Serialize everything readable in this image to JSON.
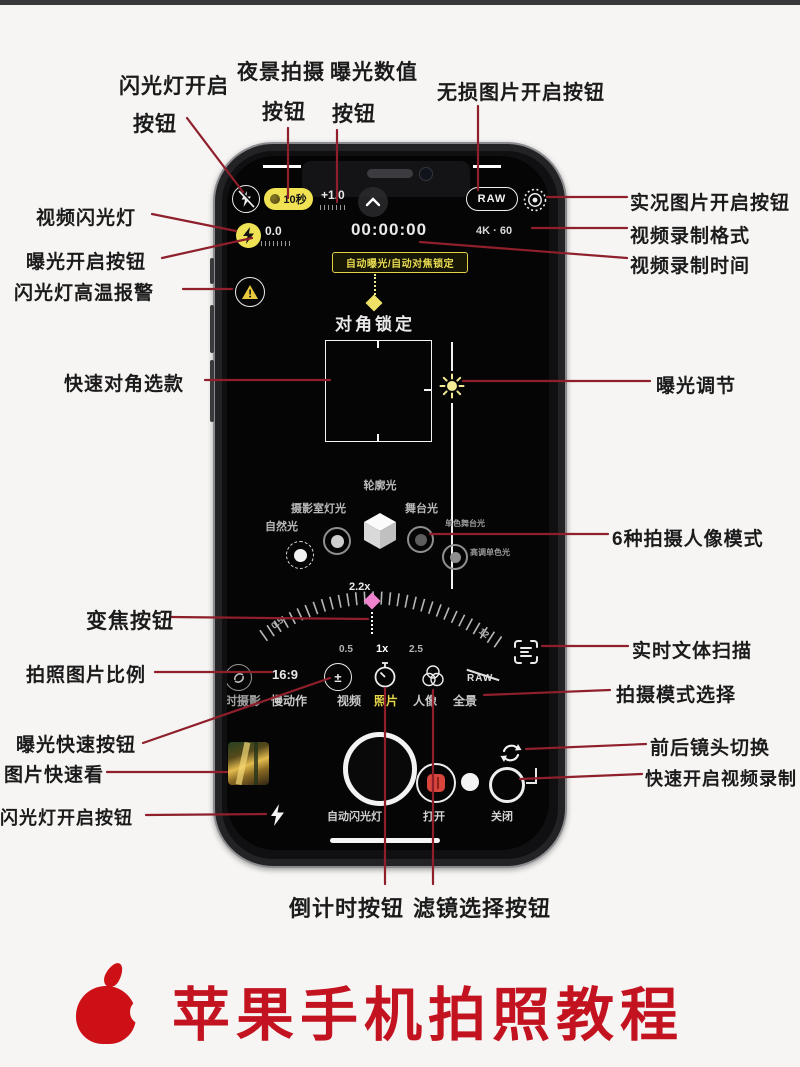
{
  "page": {
    "accent_line_color": "#8e1f2b",
    "title_color": "#c41320"
  },
  "callouts": {
    "flash_on_top": {
      "line1": "闪光灯开启",
      "line2": "按钮"
    },
    "night_mode": {
      "line1": "夜景拍摄",
      "line2": "按钮"
    },
    "exposure_value": {
      "line1": "曝光数值",
      "line2": "按钮"
    },
    "lossless": "无损图片开启按钮",
    "live_photo": "实况图片开启按钮",
    "video_format": "视频录制格式",
    "video_time": "视频录制时间",
    "video_flash": "视频闪光灯",
    "exposure_on": "曝光开启按钮",
    "flash_heat": "闪光灯高温报警",
    "quick_diag": "快速对角选款",
    "exposure_adjust": "曝光调节",
    "portrait_modes": "6种拍摄人像模式",
    "zoom_button": "变焦按钮",
    "photo_ratio": "拍照图片比例",
    "exposure_quick": "曝光快速按钮",
    "photo_quick_view": "图片快速看",
    "flash_on_bottom": "闪光灯开启按钮",
    "text_scan": "实时文体扫描",
    "mode_select": "拍摄模式选择",
    "lens_switch": "前后镜头切换",
    "quick_video": "快速开启视频录制",
    "countdown": "倒计时按钮",
    "filter_select": "滤镜选择按钮"
  },
  "screen": {
    "night_duration": "10秒",
    "ev_top": "+1.0",
    "raw_badge": "RAW",
    "ev_main": "0.0",
    "rec_time": "00:00:00",
    "rec_format": "4K · 60",
    "ae_af_banner": "自动曝光/自动对焦锁定",
    "diag_lock": "对角锁定",
    "lighting": {
      "contour": "轮廓光",
      "studio": "摄影室灯光",
      "natural": "自然光",
      "stage": "舞台光",
      "stage_mono": "单色舞台光",
      "high_key_mono": "高调单色光"
    },
    "zoom": {
      "current": "2.2x",
      "dial_left": "0.5",
      "dial_right": "12",
      "quick_1": "0.5",
      "quick_2": "1x",
      "quick_3": "2.5"
    },
    "ratio_value": "16:9",
    "raw_off": "RAW",
    "modes": [
      "延时摄影",
      "慢动作",
      "视频",
      "照片",
      "人像",
      "全景"
    ],
    "flash_status": "自动闪光灯",
    "open_label": "打开",
    "close_label": "关闭"
  },
  "footer": {
    "title": "苹果手机拍照教程"
  }
}
